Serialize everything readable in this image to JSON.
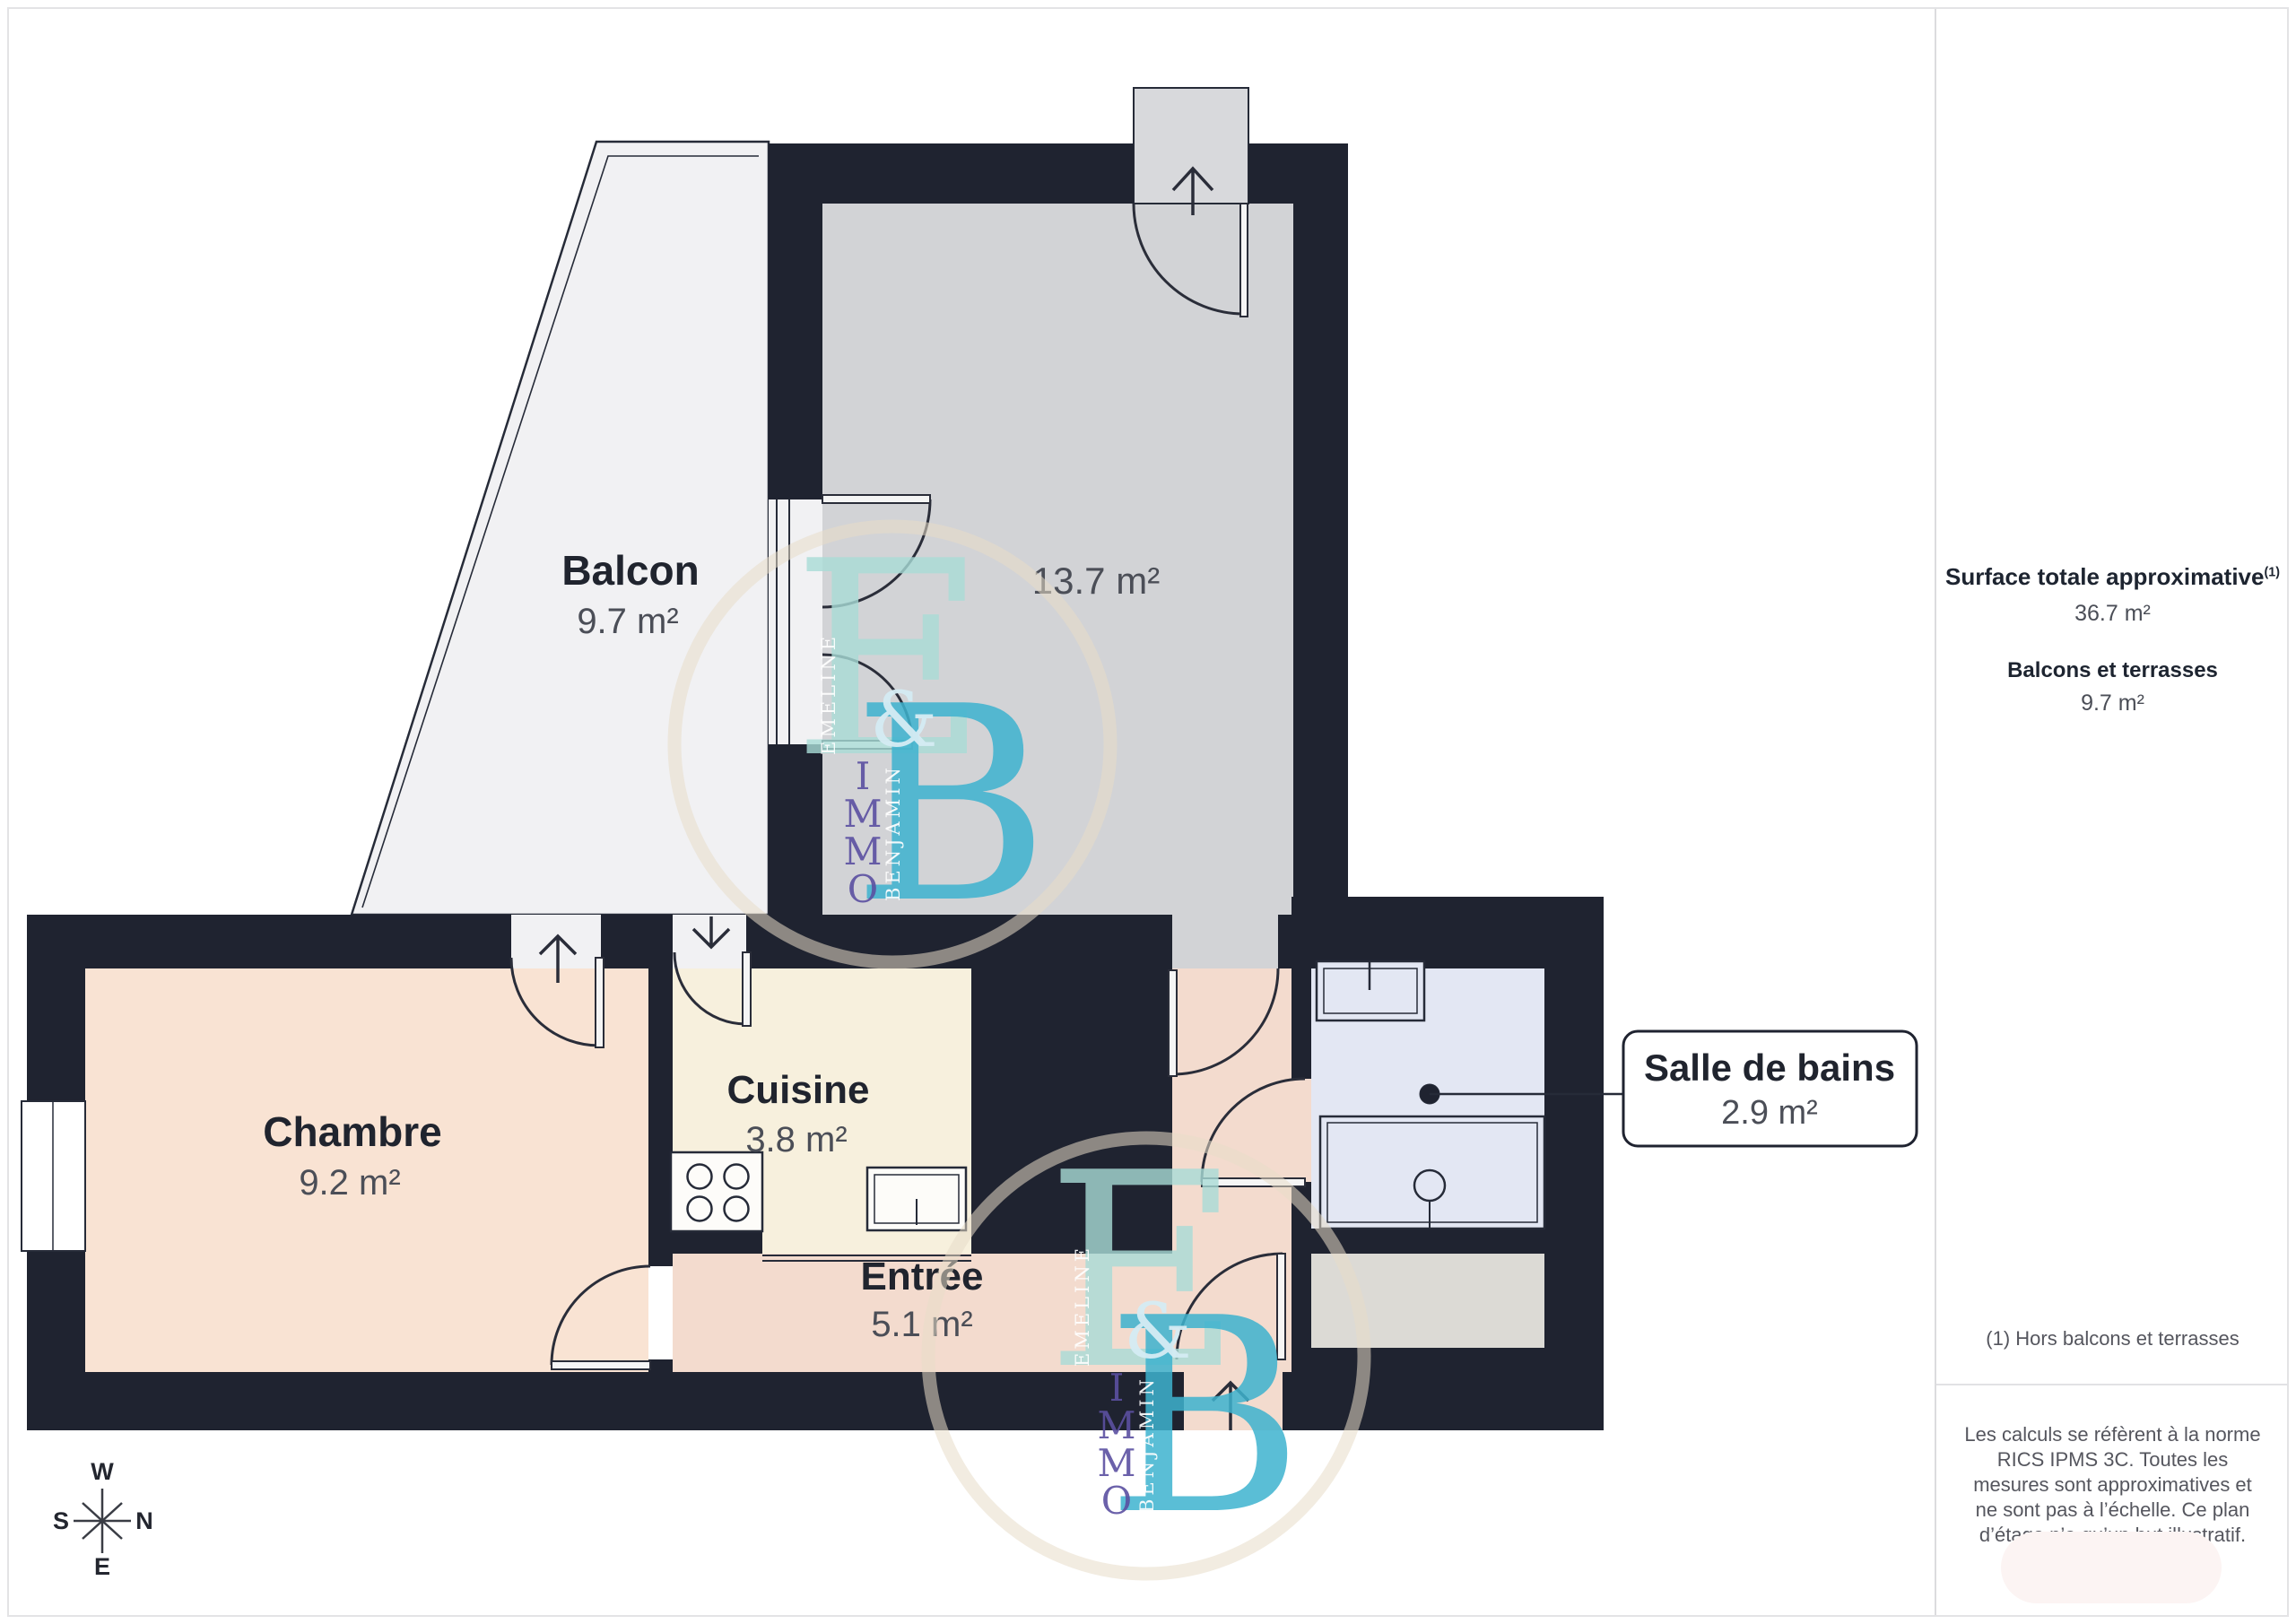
{
  "rooms": {
    "balcon": {
      "name": "Balcon",
      "area": "9.7 m²"
    },
    "sejour": {
      "area": "13.7 m²"
    },
    "chambre": {
      "name": "Chambre",
      "area": "9.2 m²"
    },
    "cuisine": {
      "name": "Cuisine",
      "area": "3.8 m²"
    },
    "entree": {
      "name": "Entrée",
      "area": "5.1 m²"
    },
    "salle_de_bains": {
      "name": "Salle de bains",
      "area": "2.9 m²"
    }
  },
  "sidebar": {
    "total_label": "Surface totale approximative",
    "total_footnote_marker": "(1)",
    "total_value": "36.7 m²",
    "balconies_label": "Balcons et terrasses",
    "balconies_value": "9.7 m²",
    "footnote": "(1) Hors balcons et terrasses",
    "disclaimer": "Les calculs se réfèrent à la norme RICS IPMS 3C. Toutes les mesures sont approximatives et ne sont pas à l’échelle. Ce plan d’étage n’a qu’un but illustratif."
  },
  "compass": {
    "w": "W",
    "n": "N",
    "s": "S",
    "e": "E"
  },
  "watermark": {
    "letter_e": "E",
    "ampersand": "&",
    "letter_b": "B",
    "name_e": "EMELINE",
    "name_b": "BENJAMIN",
    "immo_letters": [
      "I",
      "M",
      "M",
      "O"
    ]
  },
  "colors": {
    "wall": "#1f2330",
    "balcony": "#f1f1f3",
    "sejour": "#d2d3d6",
    "recess": "#d8d9dc",
    "chambre": "#f9e3d3",
    "cuisine": "#f7f0dd",
    "entree": "#f3dbce",
    "bathroom": "#e3e7f3",
    "storage": "#dcdad5",
    "watermark_e": "#a9dcd7",
    "watermark_b": "#3eb3cf",
    "watermark_immo": "#5b50a1",
    "watermark_circle": "#e8ddc8"
  }
}
